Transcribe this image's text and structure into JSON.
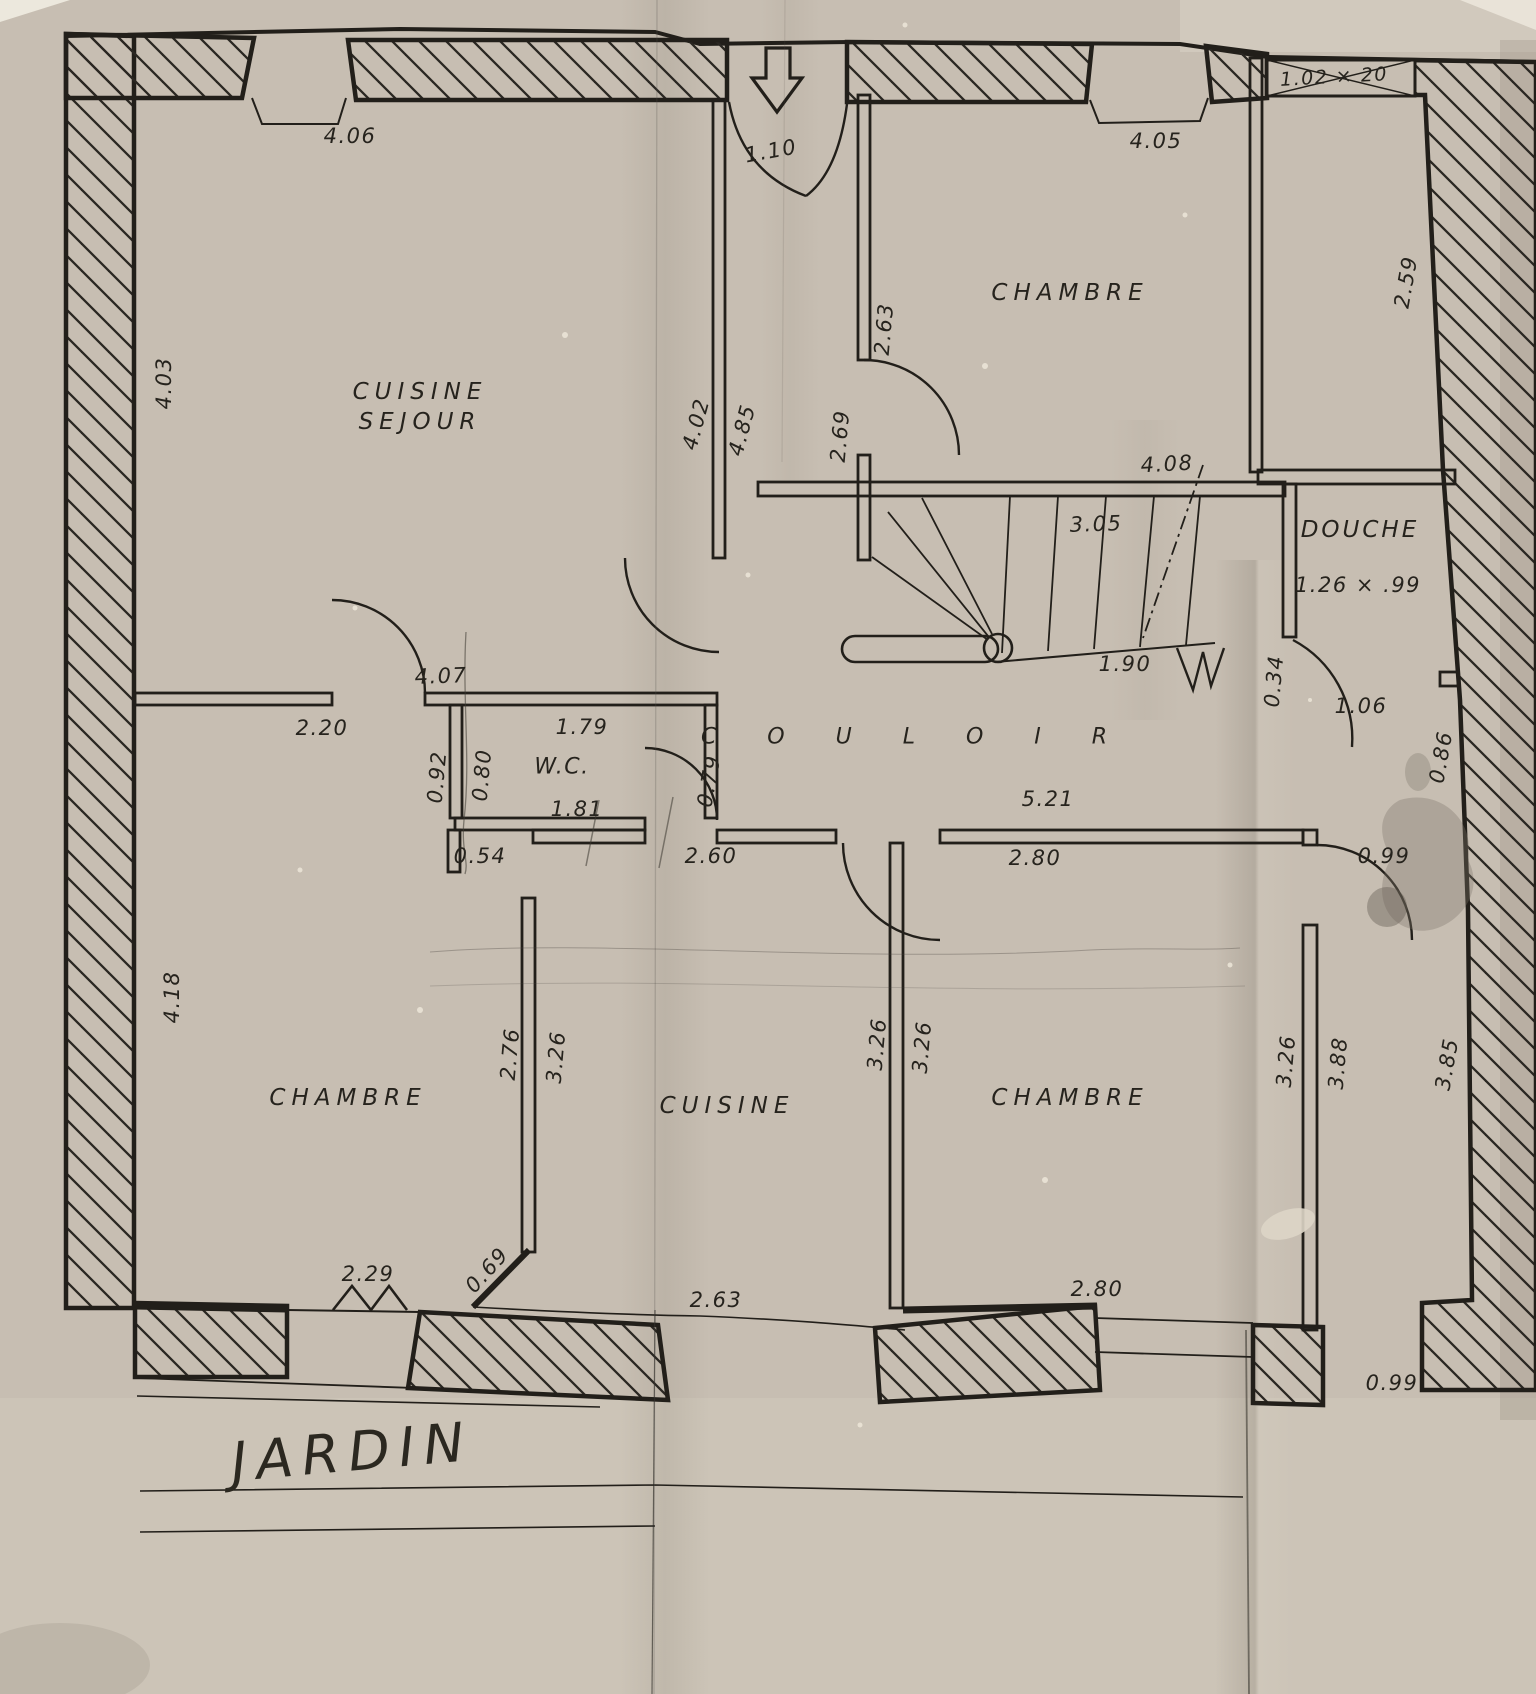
{
  "palette": {
    "paper": "#c7beb2",
    "ink": "#221f1a"
  },
  "rooms": {
    "cuisine_sejour_line1": "CUISINE",
    "cuisine_sejour_line2": "SEJOUR",
    "chambre_top_right": "CHAMBRE",
    "douche": "DOUCHE",
    "douche_size": "1.26 × .99",
    "wc": "W.C.",
    "couloir": "C O U L O I R",
    "chambre_bottom_left": "CHAMBRE",
    "cuisine": "CUISINE",
    "chambre_bottom_right": "CHAMBRE",
    "jardin": "JARDIN"
  },
  "dims": {
    "top_left": "4.06",
    "entrance": "1.10",
    "top_right": "4.05",
    "window_top_right": "1.02 × 20",
    "strip_right": "2.59",
    "cs_left": "4.03",
    "ch_tr_wall_a": "2.63",
    "ch_tr_wall_b": "2.69",
    "cs_right_a": "4.02",
    "cs_right_b": "4.85",
    "stairs_top": "4.08",
    "stairs_width": "3.05",
    "stairs_bottom": "1.90",
    "stub": "0.34",
    "douche_door": "1.06",
    "strip_mid": "0.86",
    "hall_top": "4.07",
    "hall_left": "2.20",
    "wc_top": "1.79",
    "wc_out": "0.92",
    "wc_in": "0.80",
    "wc_bottom": "1.81",
    "wc_door": "0.79",
    "step": "0.54",
    "cuisine_top": "2.60",
    "hall_bottom": "5.21",
    "ch_br_top": "2.80",
    "corridor_door": "0.99",
    "ch_bl_left": "4.18",
    "ch_bl_wall": "2.76",
    "cuisine_wall_l": "3.26",
    "cuisine_wall_r": "3.26",
    "ch_br_wall_l": "3.26",
    "ch_br_right": "3.26",
    "corridor_a": "3.88",
    "corridor_b": "3.85",
    "window_bl": "2.29",
    "diag": "0.69",
    "cuisine_bottom": "2.63",
    "ch_br_bottom": "2.80",
    "exit_bottom": "0.99"
  }
}
